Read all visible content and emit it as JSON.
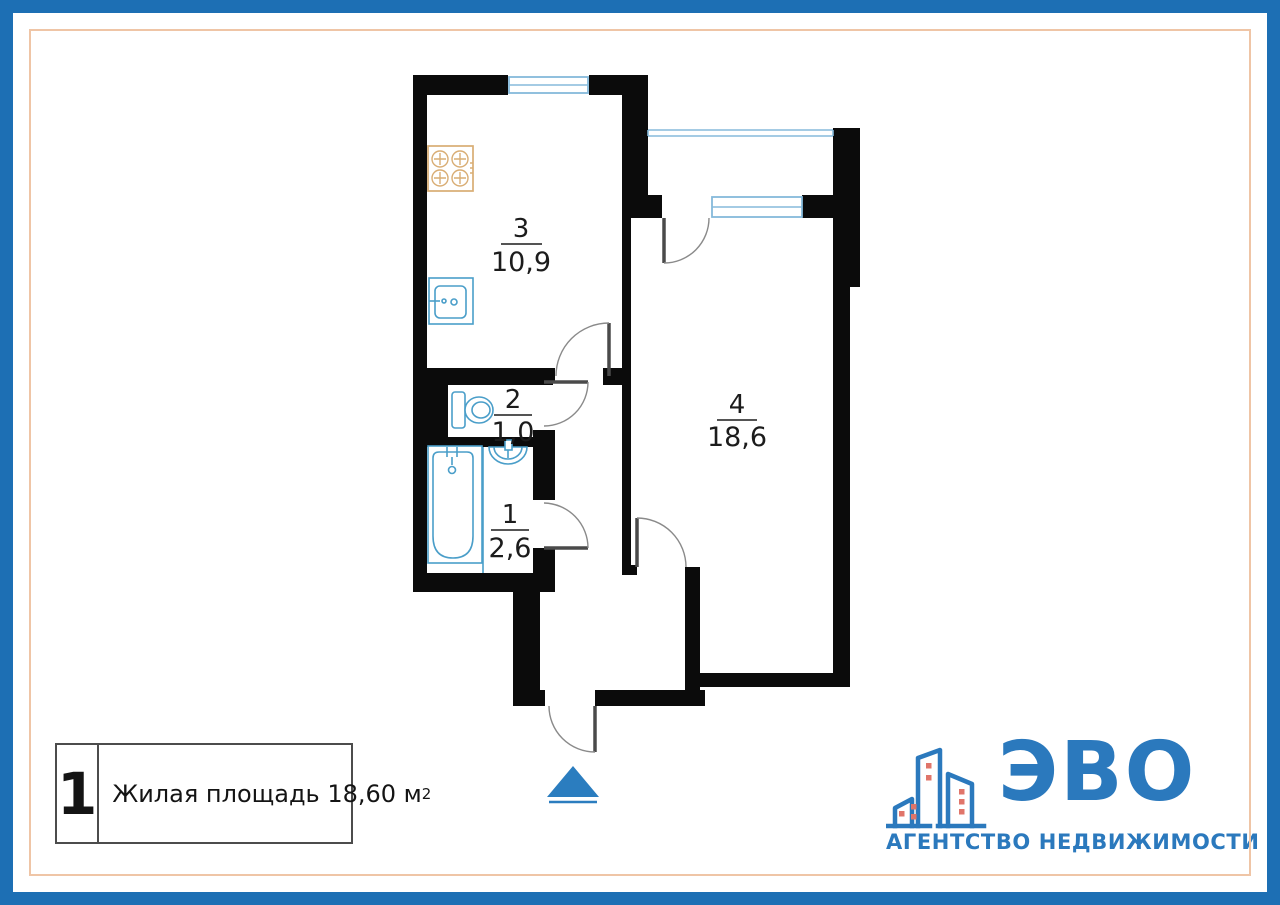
{
  "frame": {
    "outer_color": "#1d6fb4",
    "inner_line_color": "#efc5a6"
  },
  "floor_plan": {
    "wall_color": "#0b0b0b",
    "window_color": "#85badb",
    "fixture_color": "#4a9ec9",
    "stove_color": "#d9ad74",
    "door_color": "#4a4a4a",
    "entrance_marker_color": "#2b7dbf",
    "rooms": [
      {
        "name": "bathroom",
        "number": "1",
        "area": "2,6"
      },
      {
        "name": "toilet",
        "number": "2",
        "area": "1,0"
      },
      {
        "name": "kitchen",
        "number": "3",
        "area": "10,9"
      },
      {
        "name": "living-room",
        "number": "4",
        "area": "18,6"
      }
    ],
    "fixtures": [
      "stove-icon",
      "kitchen-sink-icon",
      "toilet-icon",
      "bathtub-icon",
      "washbasin-icon"
    ]
  },
  "legend": {
    "unit_number": "1",
    "label": "Жилая площадь 18,60 м",
    "superscript": "2"
  },
  "logo": {
    "name": "ЭВО",
    "subtitle": "АГЕНТСТВО НЕДВИЖИМОСТИ",
    "brand_color": "#2b79bd",
    "window_color": "#e0756a"
  }
}
